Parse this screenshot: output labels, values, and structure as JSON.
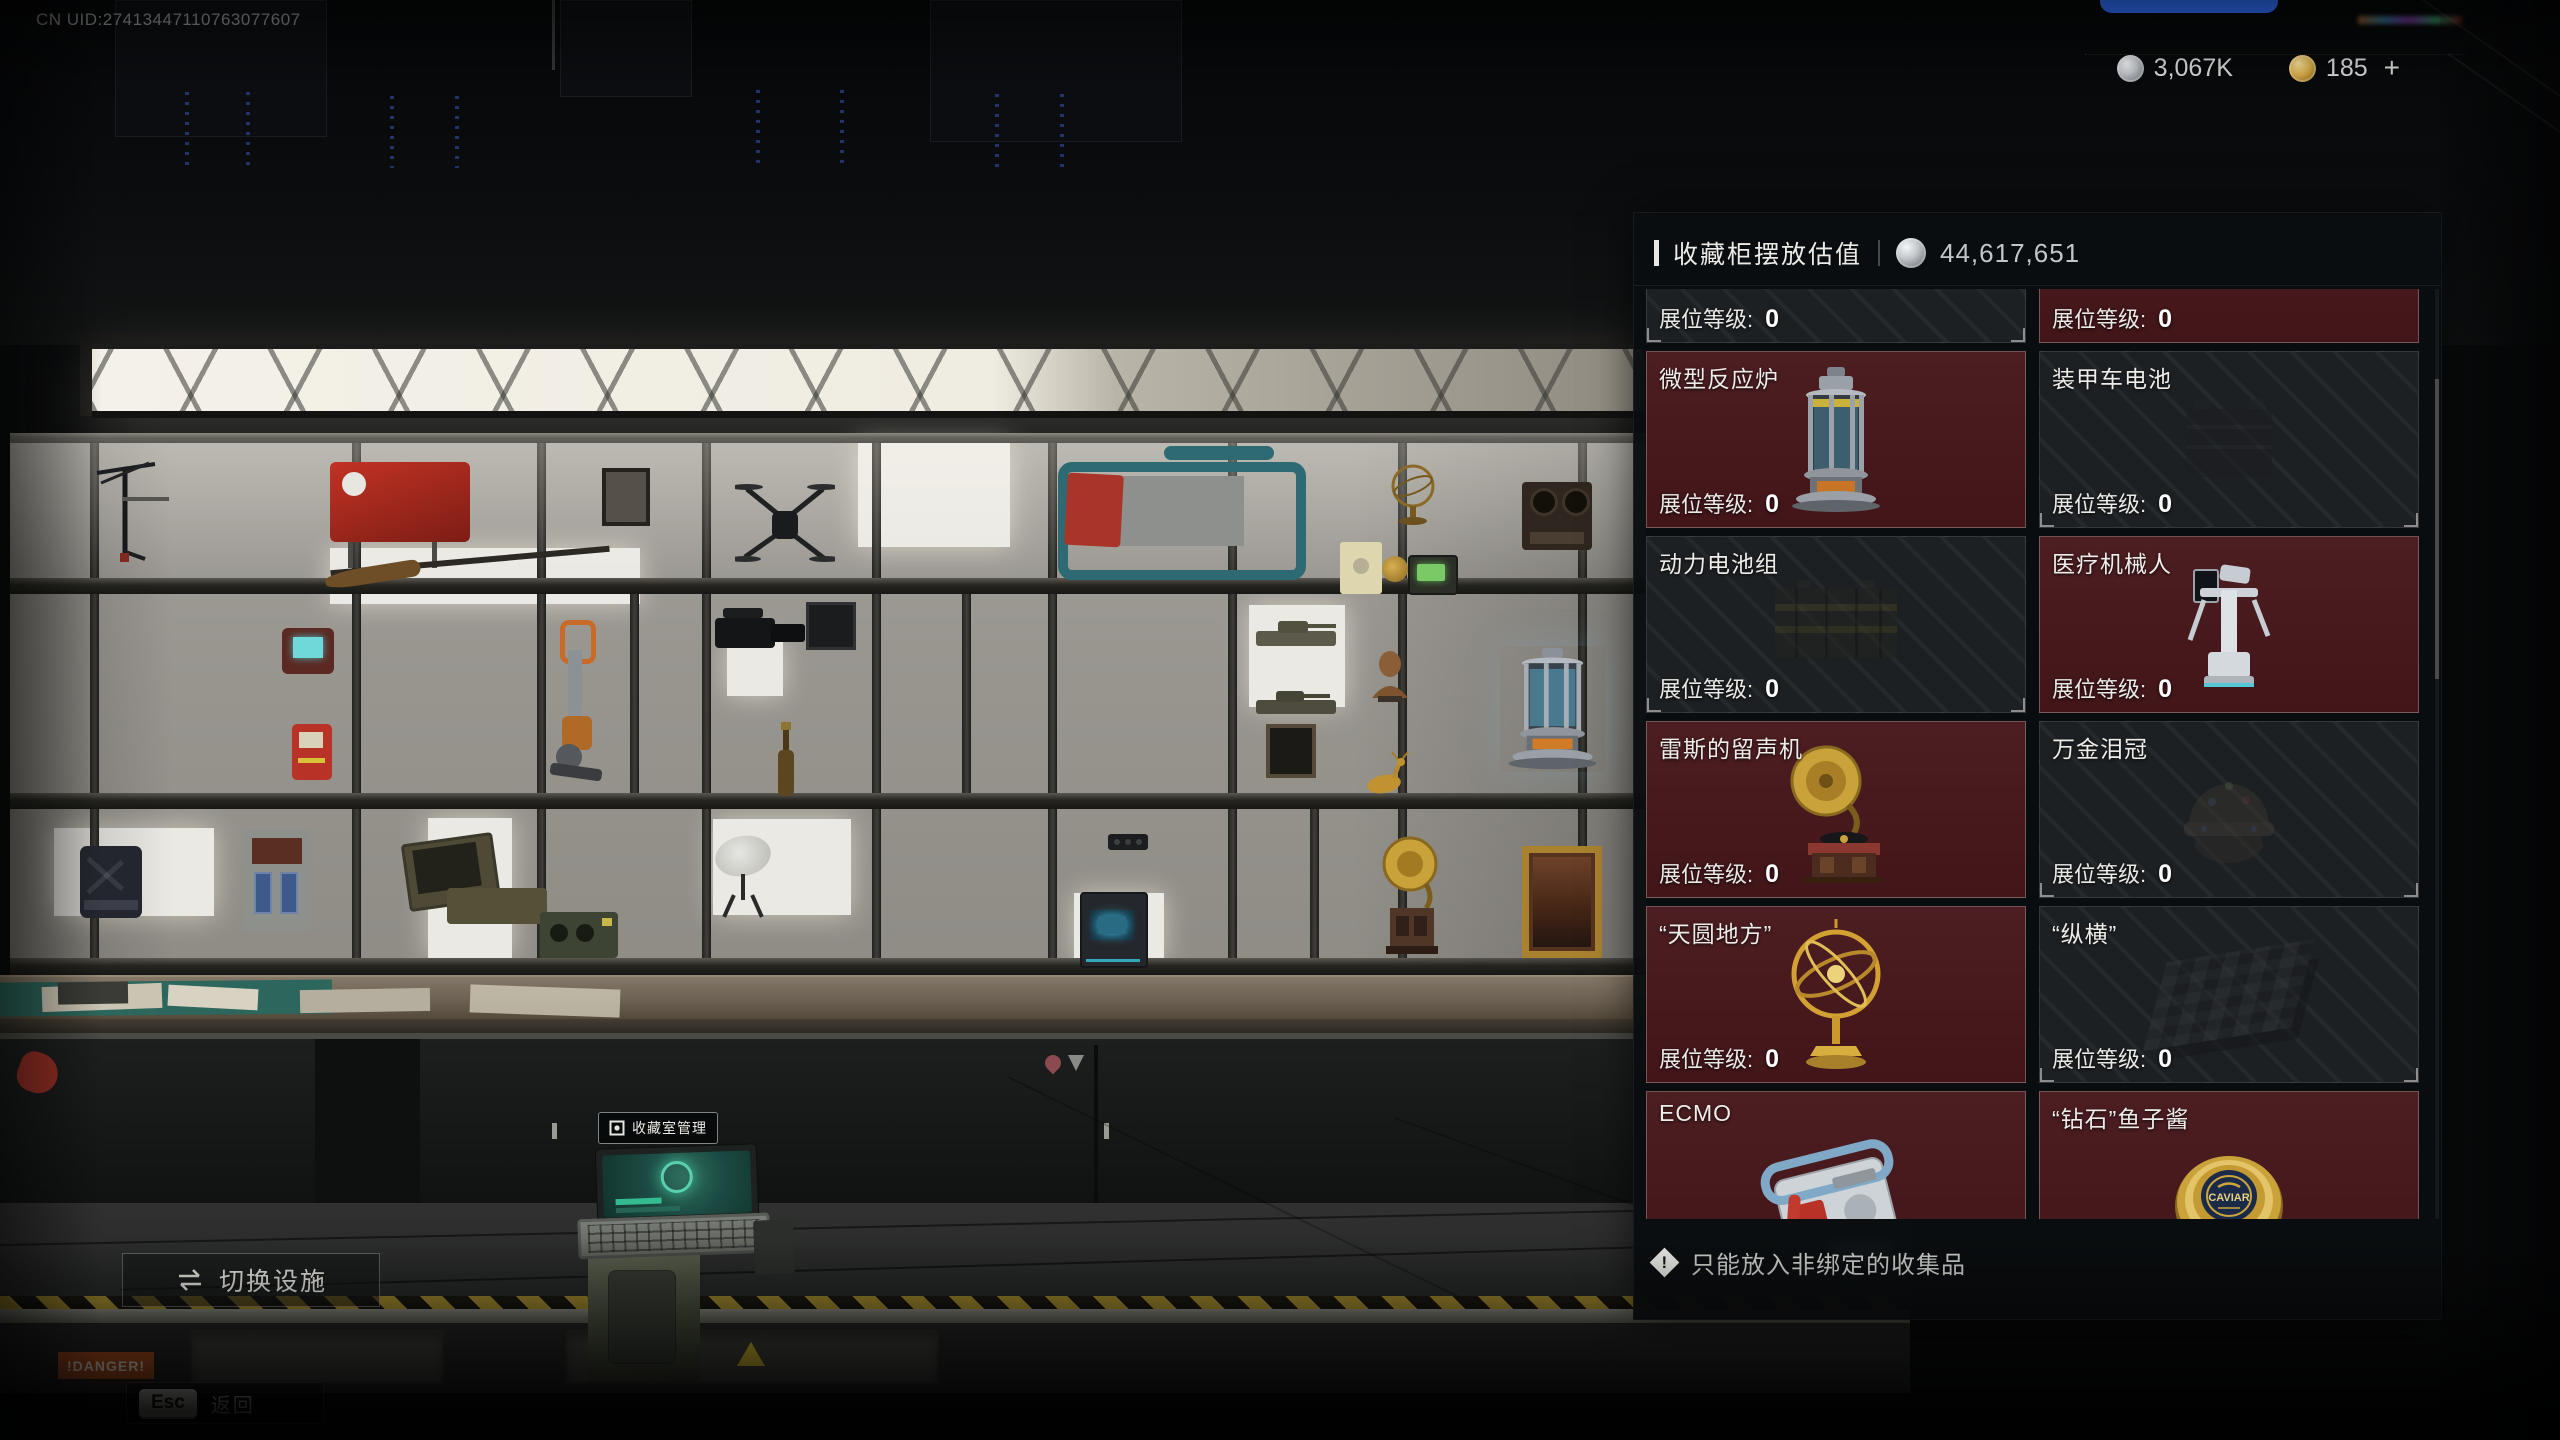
{
  "hud": {
    "uid": "CN UID:27413447110763077607",
    "currencies": [
      {
        "icon": "silver-coin",
        "value": "3,067K"
      },
      {
        "icon": "gold-coin",
        "value": "185",
        "suffix": "+"
      }
    ],
    "switch_facility": "切换设施",
    "esc_key": "Esc",
    "esc_label": "返回",
    "terminal_label": "收藏室管理"
  },
  "scene": {
    "danger_label": "!DANGER!"
  },
  "panel": {
    "title": "收藏柜摆放估值",
    "total_value": "44,617,651",
    "booth_level_label": "展位等级:",
    "footer_note": "只能放入非绑定的收集品",
    "items": [
      {
        "name": "",
        "level": "0",
        "state": "dimmed"
      },
      {
        "name": "",
        "level": "0",
        "state": "highlighted"
      },
      {
        "name": "微型反应炉",
        "level": "0",
        "state": "highlighted"
      },
      {
        "name": "装甲车电池",
        "level": "0",
        "state": "dimmed"
      },
      {
        "name": "动力电池组",
        "level": "0",
        "state": "dimmed"
      },
      {
        "name": "医疗机械人",
        "level": "0",
        "state": "highlighted"
      },
      {
        "name": "雷斯的留声机",
        "level": "0",
        "state": "highlighted"
      },
      {
        "name": "万金泪冠",
        "level": "0",
        "state": "dimmed"
      },
      {
        "name": "“天圆地方”",
        "level": "0",
        "state": "highlighted"
      },
      {
        "name": "“纵横”",
        "level": "0",
        "state": "dimmed"
      },
      {
        "name": "ECMO",
        "level": "0",
        "state": "highlighted"
      },
      {
        "name": "“钻石”鱼子酱",
        "level": "0",
        "state": "highlighted",
        "art_label": "CAVIAR"
      }
    ]
  }
}
